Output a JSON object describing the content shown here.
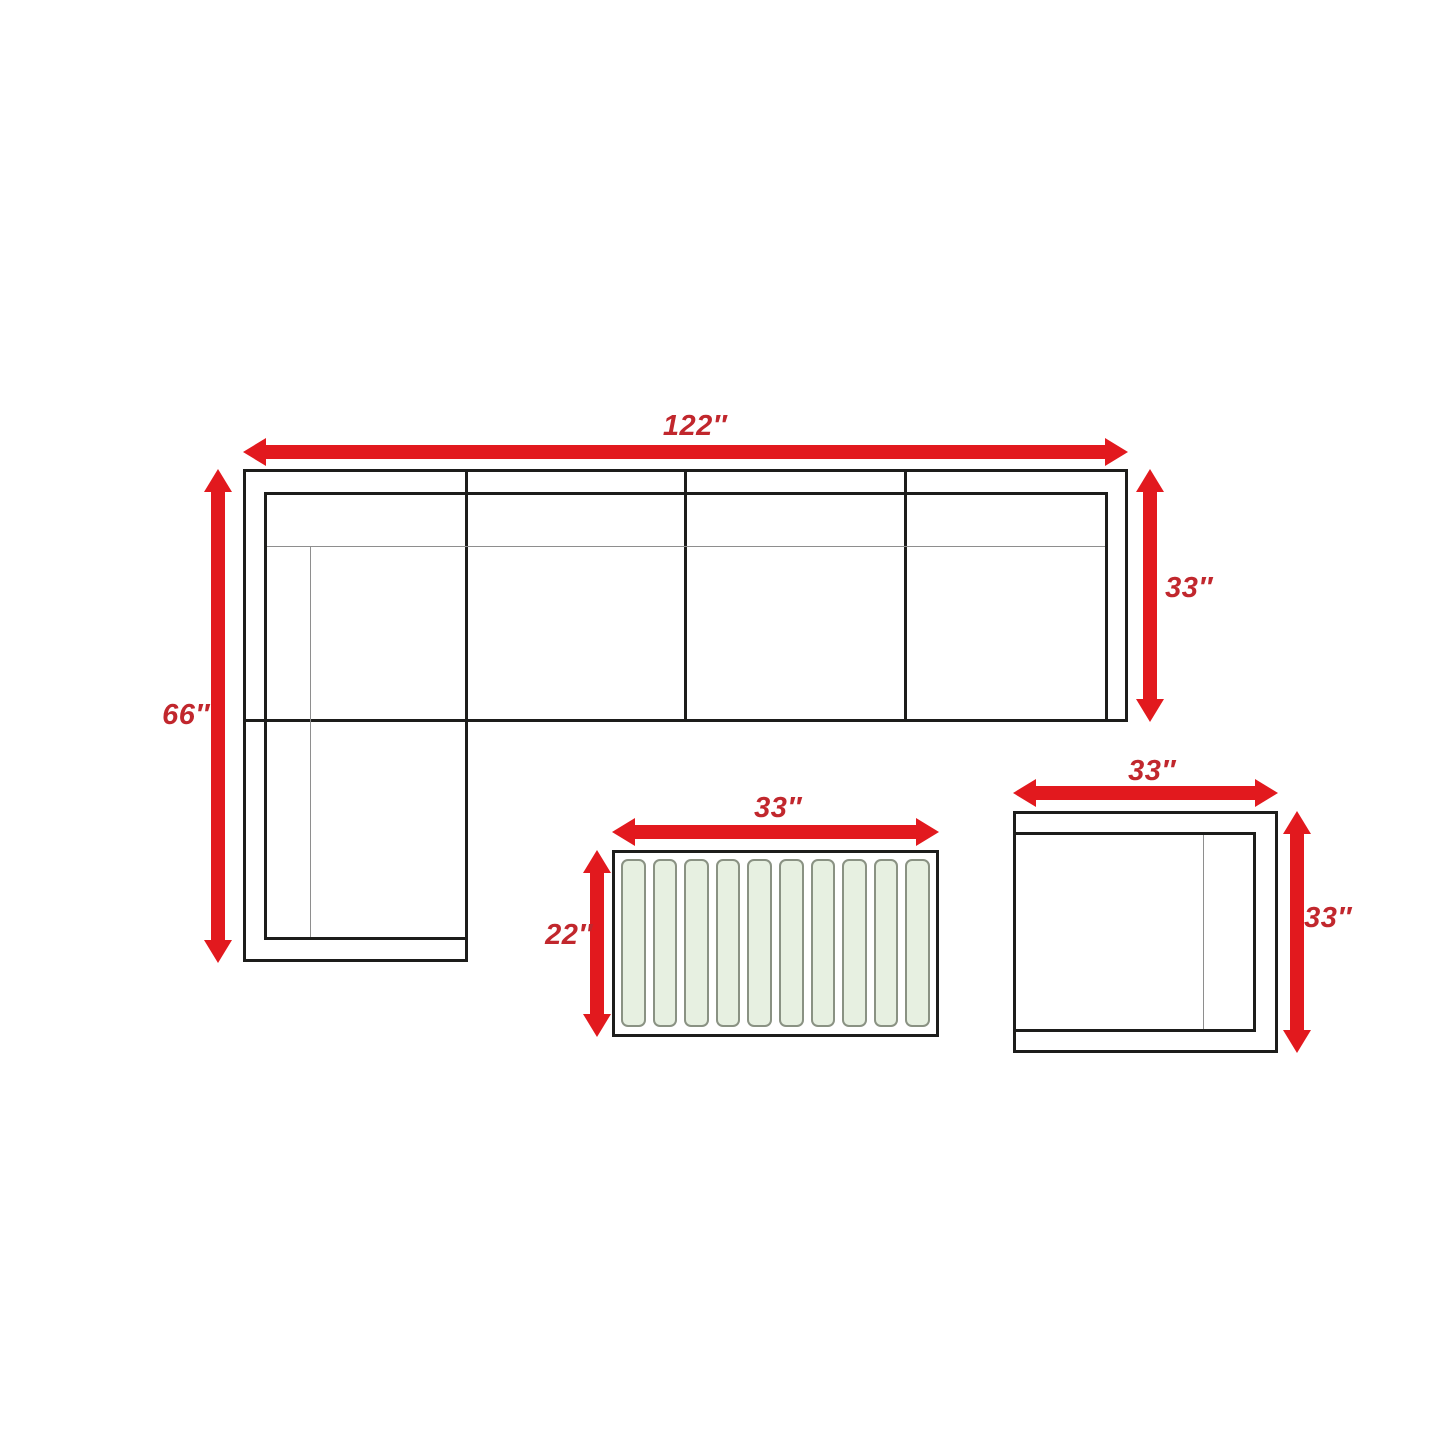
{
  "colors": {
    "arrow": "#e2191e",
    "dimension_label": "#c1272d",
    "furniture_outline": "#1d1d1b",
    "detail_line": "#8e8e8e",
    "slat_fill": "#e7f0e1",
    "slat_border": "#8a9283",
    "background": "#ffffff"
  },
  "sectional_sofa": {
    "name": "L-shaped sectional sofa (top view)",
    "width": {
      "value": 122,
      "unit": "inches",
      "label": "122″"
    },
    "depth": {
      "value": 33,
      "unit": "inches",
      "label": "33″"
    },
    "chaise_length": {
      "value": 66,
      "unit": "inches",
      "label": "66″"
    },
    "seat_sections": 4
  },
  "coffee_table": {
    "name": "Slatted coffee table (top view)",
    "width": {
      "value": 33,
      "unit": "inches",
      "label": "33″"
    },
    "depth": {
      "value": 22,
      "unit": "inches",
      "label": "22″"
    },
    "slat_count": 10
  },
  "end_table": {
    "name": "End table (top view)",
    "width": {
      "value": 33,
      "unit": "inches",
      "label": "33″"
    },
    "depth": {
      "value": 33,
      "unit": "inches",
      "label": "33″"
    }
  }
}
